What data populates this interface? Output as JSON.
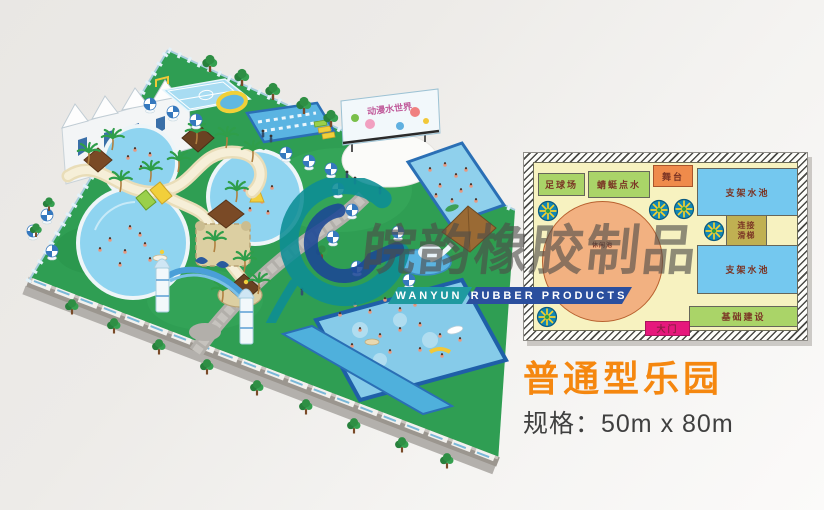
{
  "watermark": {
    "company_cn": "皖韵橡胶制品",
    "brand_left": "WANYUN",
    "brand_right": "RUBBER PRODUCTS",
    "teal": "#1e9aa0",
    "blue": "#2b4f9e"
  },
  "park": {
    "billboard_text": "动漫水世界"
  },
  "plan": {
    "background": "#f7f2c0",
    "zones": [
      {
        "label": "足球场",
        "color": "#aad468"
      },
      {
        "label": "蜻蜓点水",
        "color": "#aad468"
      },
      {
        "label": "舞台",
        "color": "#ef8b4b"
      },
      {
        "label": "支架水池",
        "color": "#74c8ef"
      },
      {
        "label": "连接滑梯",
        "line1": "连接",
        "line2": "滑梯",
        "color": "#c0b052"
      },
      {
        "label": "支架水池",
        "color": "#74c8ef"
      },
      {
        "label": "基础建设",
        "color": "#aad468"
      },
      {
        "label": "大门",
        "color": "#e6187c"
      },
      {
        "label": "休闲池",
        "color": "#f2b181"
      }
    ]
  },
  "footer": {
    "title": "普通型乐园",
    "title_color": "#f5870f",
    "spec": "规格：50m x 80m"
  }
}
